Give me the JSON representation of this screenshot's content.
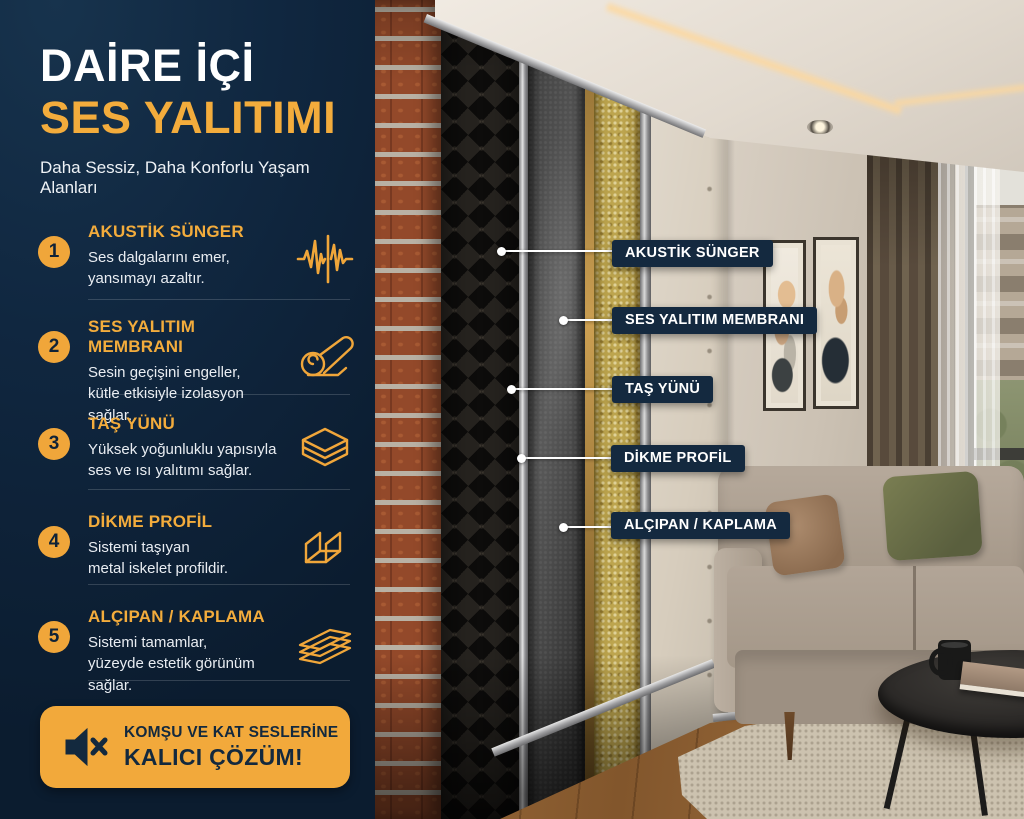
{
  "colors": {
    "accent_yellow": "#F2A93B",
    "panel_navy": "#0E2337",
    "badge_navy": "#14293F",
    "text_white": "#FFFFFF",
    "title_yellow": "#F3AC3C"
  },
  "header": {
    "title_line1": "DAİRE İÇİ",
    "title_line2": "SES YALITIMI",
    "subtitle": "Daha Sessiz, Daha Konforlu Yaşam Alanları"
  },
  "items": [
    {
      "number": "1",
      "title": "AKUSTİK SÜNGER",
      "description": "Ses dalgalarını emer,\nyansımayı azaltır.",
      "icon": "waveform-icon"
    },
    {
      "number": "2",
      "title": "SES YALITIM MEMBRANI",
      "description": "Sesin geçişini engeller,\nkütle etkisiyle izolasyon sağlar.",
      "icon": "membrane-roll-icon"
    },
    {
      "number": "3",
      "title": "TAŞ YÜNÜ",
      "description": "Yüksek yoğunluklu yapısıyla\nses ve ısı yalıtımı sağlar.",
      "icon": "stacked-layers-icon"
    },
    {
      "number": "4",
      "title": "DİKME PROFİL",
      "description": "Sistemi taşıyan\nmetal iskelet profildir.",
      "icon": "u-profile-icon"
    },
    {
      "number": "5",
      "title": "ALÇIPAN / KAPLAMA",
      "description": "Sistemi tamamlar,\nyüzeyde estetik görünüm sağlar.",
      "icon": "panel-sheets-icon"
    }
  ],
  "cta": {
    "line1": "KOMŞU VE KAT SESLERİNE",
    "line2": "KALICI ÇÖZÜM!",
    "icon": "muted-speaker-icon"
  },
  "callouts": [
    {
      "text": "AKUSTİK SÜNGER"
    },
    {
      "text": "SES YALITIM MEMBRANI"
    },
    {
      "text": "TAŞ YÜNÜ"
    },
    {
      "text": "DİKME PROFİL"
    },
    {
      "text": "ALÇIPAN / KAPLAMA"
    }
  ]
}
